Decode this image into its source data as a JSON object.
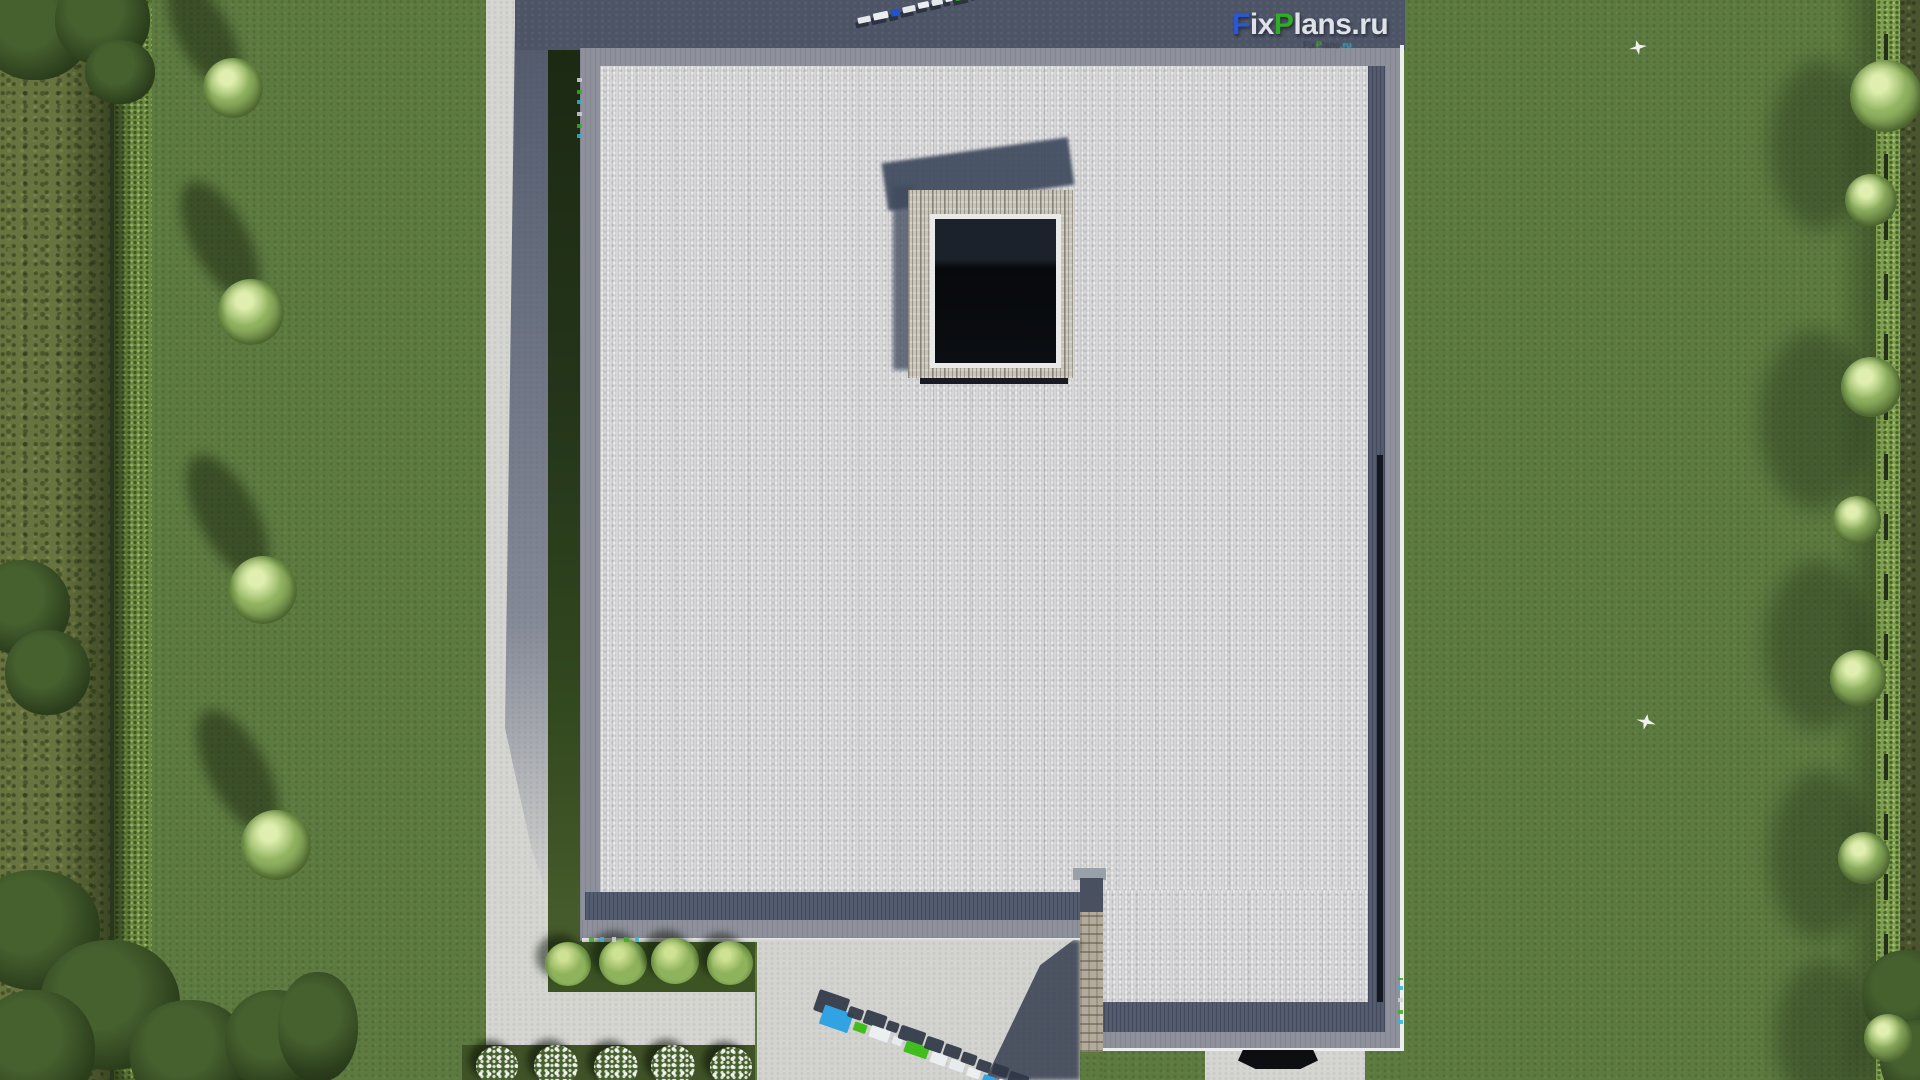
{
  "watermark": {
    "main": {
      "f": "F",
      "ix": "ix",
      "p": "P",
      "lans": "lans",
      "dotru": ".ru"
    },
    "small": {
      "f": "F",
      "ix": "ix",
      "p": "P",
      "lans": "lans",
      "dot": ".",
      "ru": "ru"
    },
    "label_3d": "FixPlans.ru"
  },
  "palette": {
    "brand_blue": "#2b59d6",
    "brand_green": "#2fae24",
    "brand_white": "#dfe2e8",
    "roof_field": "#d6d6d7",
    "parapet_gray": "#8e919b",
    "parapet_dark": "#535b6e",
    "shadow_slate": "#4c5466",
    "lawn_green": "#5d7a40",
    "hedge_green": "#7fa04e",
    "pavement": "#d5d5d2",
    "stone": "#b2aa9a",
    "skylight_glass": "#0b0e12"
  },
  "blocks3d": {
    "top": [
      {
        "c": "#e6e9ec",
        "w": 13,
        "h": 6,
        "dy": 2
      },
      {
        "c": "#eceef1",
        "w": 15,
        "h": 7,
        "dy": 1
      },
      {
        "c": "#2153cc",
        "w": 9,
        "h": 7,
        "dy": 1
      },
      {
        "c": "#e6e9ec",
        "w": 13,
        "h": 6,
        "dy": 1
      },
      {
        "c": "#eceef1",
        "w": 11,
        "h": 6,
        "dy": 0
      },
      {
        "c": "#e6e9ec",
        "w": 11,
        "h": 6,
        "dy": 0
      },
      {
        "c": "#eceef1",
        "w": 7,
        "h": 5,
        "dy": 0
      },
      {
        "c": "#2fae24",
        "w": 15,
        "h": 7,
        "dy": -1
      },
      {
        "c": "#eceef1",
        "w": 12,
        "h": 6,
        "dy": -1
      },
      {
        "c": "#2fae24",
        "w": 8,
        "h": 6,
        "dy": -2
      },
      {
        "c": "#1f55d2",
        "w": 20,
        "h": 11,
        "dy": -5
      }
    ],
    "bottom": [
      {
        "c": "#31a2e2",
        "w": 30,
        "h": 20,
        "dy": 0
      },
      {
        "c": "#3fbe1e",
        "w": 13,
        "h": 9,
        "dy": 6
      },
      {
        "c": "#eceff1",
        "w": 20,
        "h": 12,
        "dy": 4
      },
      {
        "c": "#e8ebee",
        "w": 10,
        "h": 8,
        "dy": 7
      },
      {
        "c": "#3fbe1e",
        "w": 24,
        "h": 12,
        "dy": 7
      },
      {
        "c": "#eceff1",
        "w": 16,
        "h": 11,
        "dy": 9
      },
      {
        "c": "#e8ebee",
        "w": 15,
        "h": 10,
        "dy": 10
      },
      {
        "c": "#eceff1",
        "w": 13,
        "h": 9,
        "dy": 12
      },
      {
        "c": "#2fa7e6",
        "w": 12,
        "h": 9,
        "dy": 14
      },
      {
        "c": "#eceff1",
        "w": 14,
        "h": 9,
        "dy": 13
      },
      {
        "c": "#e8ebee",
        "w": 18,
        "h": 10,
        "dy": 15
      }
    ]
  }
}
